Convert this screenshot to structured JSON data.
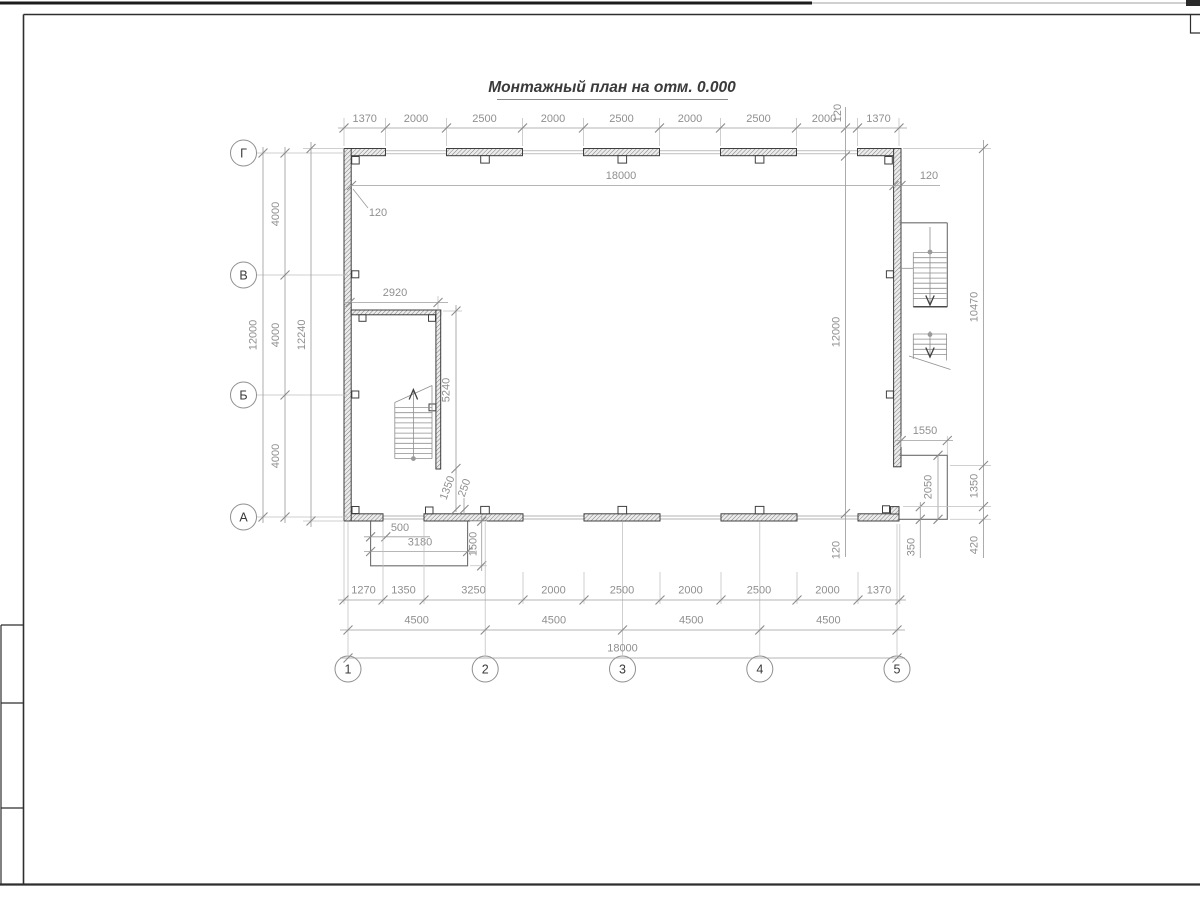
{
  "title": {
    "text": "Монтажный план на отм. 0.000"
  },
  "axes": {
    "cols": [
      "1",
      "2",
      "3",
      "4",
      "5"
    ],
    "rows": [
      "Г",
      "В",
      "Б",
      "А"
    ]
  },
  "dims": {
    "top": [
      "1370",
      "2000",
      "2500",
      "2000",
      "2500",
      "2000",
      "2500",
      "2000",
      "1370"
    ],
    "top_offset": "120",
    "inner_w": "18000",
    "inner_w_off_r": "120",
    "inner_w_off_l": "120",
    "inner_h": "12000",
    "inner_h_off_t": "120",
    "inner_h_off_b": "120",
    "left_spans": [
      "4000",
      "4000",
      "4000"
    ],
    "left_total": "12000",
    "left_overall": "12240",
    "bottom1": [
      "1270",
      "1350",
      "3250",
      "2000",
      "2500",
      "2000",
      "2500",
      "2000",
      "1370"
    ],
    "bottom2": [
      "4500",
      "4500",
      "4500",
      "4500"
    ],
    "bottom_total": "18000",
    "stairwell_width": "2920",
    "stairwell_height": "5240",
    "stairwell_door": "1350",
    "stairwell_off": "250",
    "porch_l_inset": "500",
    "porch_l_width": "3180",
    "porch_l_depth": "1500",
    "right_stair_len": "10470",
    "porch_r_width": "1550",
    "porch_r_height": "2050",
    "porch_r_span": "1350",
    "porch_r_bottom": "420",
    "porch_r_step": "350",
    "bottom_off": "120"
  }
}
